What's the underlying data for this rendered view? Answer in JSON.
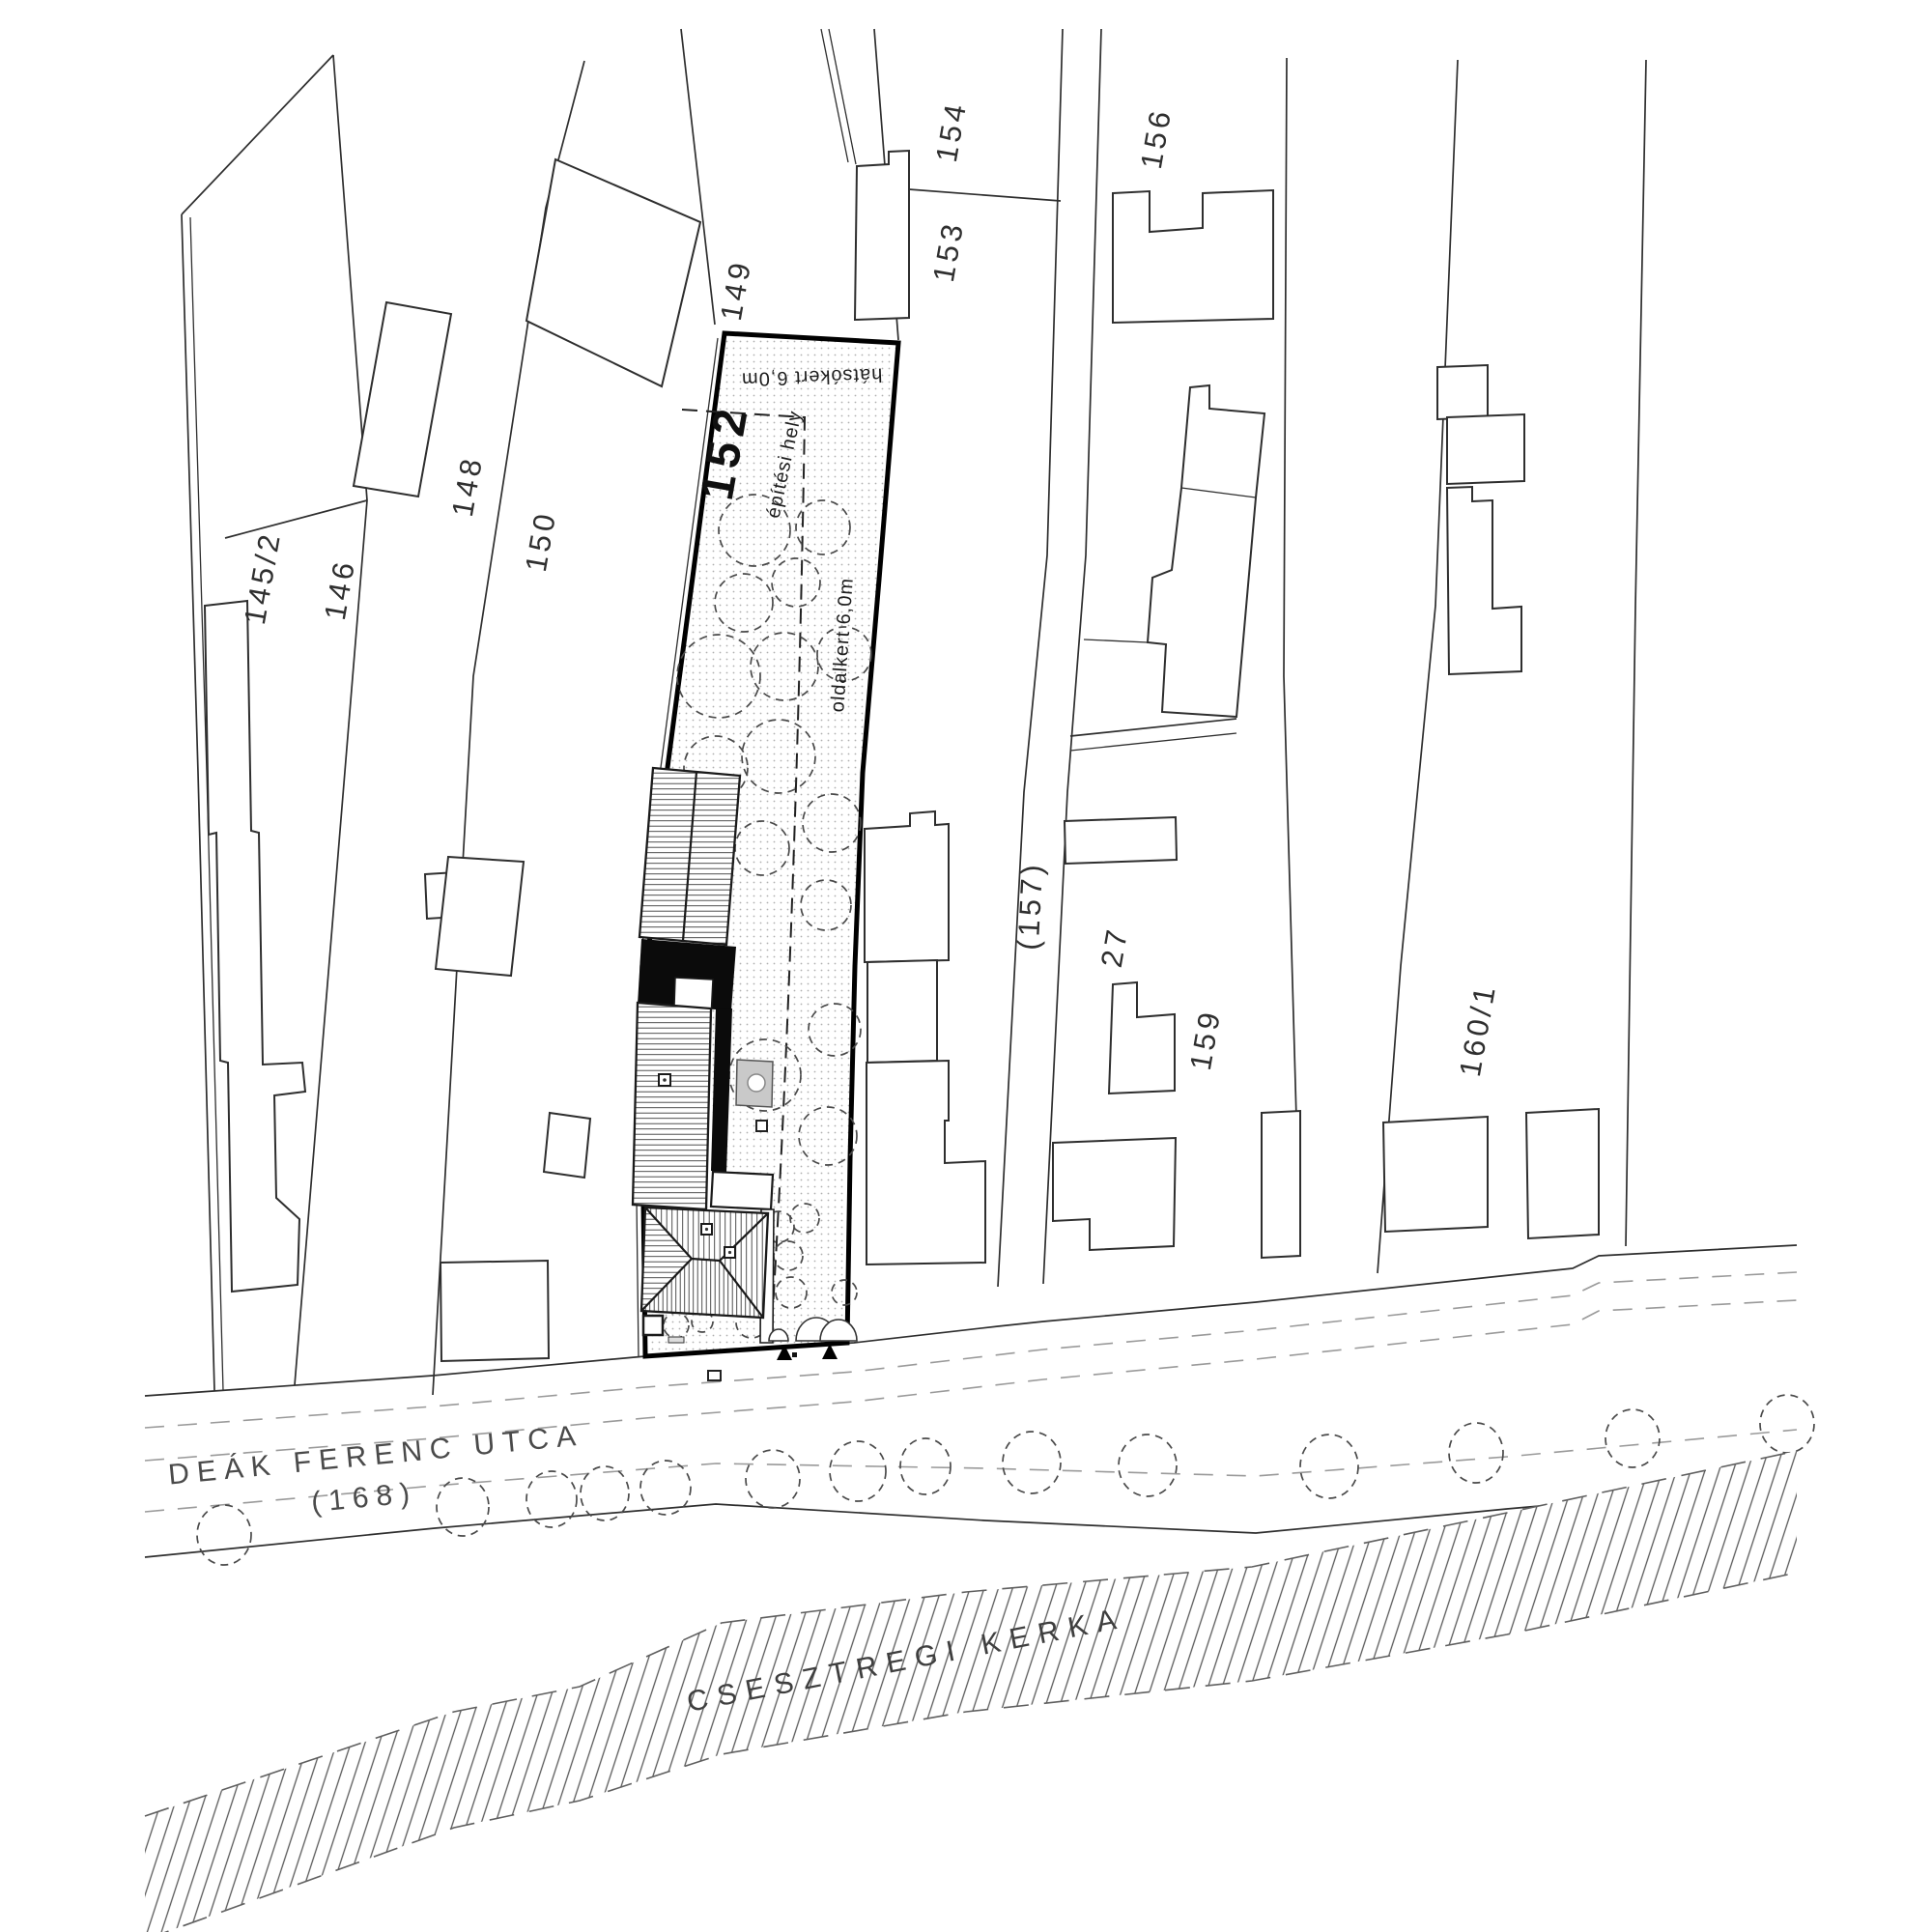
{
  "drawing": {
    "kind": "architectural site plan"
  },
  "plot": {
    "number": "152",
    "back_yard_label": "hátsókert 6,0m",
    "building_area_label": "építési hely",
    "side_yard_label": "oldalkert 6,0m"
  },
  "parcels": [
    {
      "label": "145/2"
    },
    {
      "label": "146"
    },
    {
      "label": "148"
    },
    {
      "label": "150"
    },
    {
      "label": "149"
    },
    {
      "label": "154"
    },
    {
      "label": "153"
    },
    {
      "label": "156"
    },
    {
      "label": "(157)"
    },
    {
      "label": "27"
    },
    {
      "label": "159"
    },
    {
      "label": "160/1"
    }
  ],
  "street": {
    "name": "DEÁK FERENC UTCA",
    "number": "(168)"
  },
  "river": {
    "name": "CSESZTREGI KERKA"
  },
  "colors": {
    "new_building_fill": "#0b0b0b",
    "terrace_fill": "#c9c9c9",
    "line": "#2e2e2e",
    "label": "#2f2f2f",
    "street_label": "#4a4a4a"
  }
}
